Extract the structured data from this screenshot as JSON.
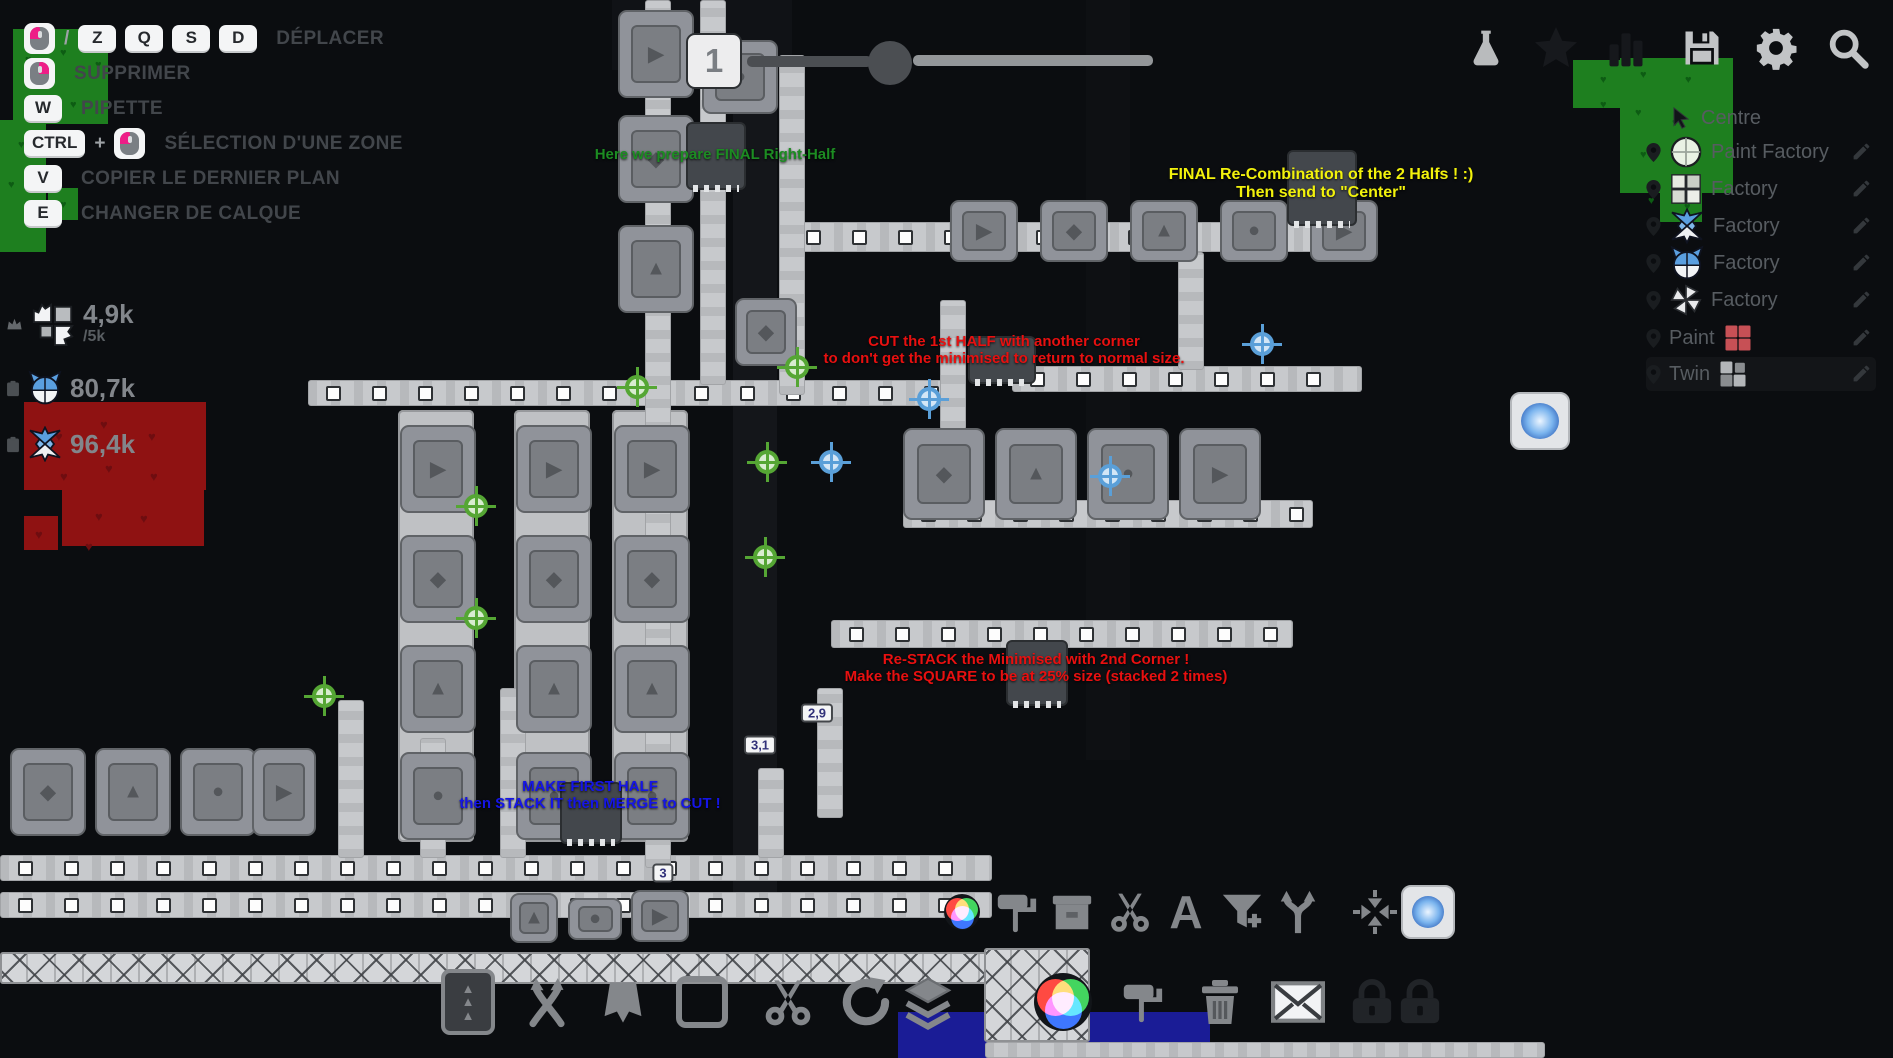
{
  "colors": {
    "background": "#0b0d10",
    "belt": "#c7c9cc",
    "machine": "#90939a",
    "patch_green": "#1e7f1f",
    "patch_red": "#8f1212",
    "patch_blue": "#1a1c96",
    "annotation_yellow": "#f2f20c",
    "annotation_red": "#e81010",
    "annotation_blue": "#1515e6",
    "annotation_green": "#1c8c22",
    "hud_text": "#42464b"
  },
  "hud": {
    "shortcuts": [
      {
        "keys": [
          "MOUSE_LEFT",
          "/",
          "Z",
          "Q",
          "S",
          "D"
        ],
        "label": "DÉPLACER"
      },
      {
        "keys": [
          "MOUSE_RIGHT"
        ],
        "label": "SUPPRIMER"
      },
      {
        "keys": [
          "W"
        ],
        "label": "PIPETTE"
      },
      {
        "keys": [
          "CTRL",
          "+",
          "MOUSE_LEFT"
        ],
        "label": "SÉLECTION D'UNE ZONE"
      },
      {
        "keys": [
          "V"
        ],
        "label": "COPIER LE DERNIER PLAN"
      },
      {
        "keys": [
          "E"
        ],
        "label": "CHANGER DE CALQUE"
      }
    ],
    "counters": [
      {
        "icon": "shape-wings",
        "value": "4,9k",
        "goal": "/5k",
        "crown": true,
        "clipboard": false
      },
      {
        "icon": "shape-cat-blue",
        "value": "80,7k",
        "goal": "",
        "crown": false,
        "clipboard": true
      },
      {
        "icon": "shape-fox-blue",
        "value": "96,4k",
        "goal": "",
        "crown": false,
        "clipboard": true
      }
    ],
    "topbar": {
      "slot": "1"
    },
    "top_buttons": [
      {
        "name": "research-flask",
        "active": true
      },
      {
        "name": "achievements-star",
        "active": false
      },
      {
        "name": "statistics-bars",
        "active": false
      },
      {
        "name": "save-disk",
        "active": true
      },
      {
        "name": "settings-gear",
        "active": true
      },
      {
        "name": "search-magnifier",
        "active": true
      }
    ],
    "markers": [
      {
        "label": "Centre",
        "icon": "cursor-arrow",
        "trailing_icon": "",
        "pin": false,
        "pencil": false
      },
      {
        "label": "Paint Factory",
        "icon": "shape-circle-cross",
        "trailing_icon": "",
        "pin": true,
        "pencil": true
      },
      {
        "label": "Factory",
        "icon": "shape-squares-pale",
        "trailing_icon": "",
        "pin": true,
        "pencil": true
      },
      {
        "label": "Factory",
        "icon": "shape-fox-blue",
        "trailing_icon": "",
        "pin": true,
        "pencil": true
      },
      {
        "label": "Factory",
        "icon": "shape-cat-blue",
        "trailing_icon": "",
        "pin": true,
        "pencil": true
      },
      {
        "label": "Factory",
        "icon": "shape-windmill-white",
        "trailing_icon": "",
        "pin": true,
        "pencil": true
      },
      {
        "label": "Paint",
        "icon": "",
        "trailing_icon": "grid-red",
        "pin": true,
        "pencil": true
      },
      {
        "label": "Twin",
        "icon": "",
        "trailing_icon": "grid-gray",
        "pin": true,
        "pencil": true
      }
    ],
    "toolbar_top": [
      "color-wheel",
      "paint-roller",
      "storage-crate",
      "scissors",
      "letter-A",
      "filter-funnel",
      "splitter-arrows",
      "compress-arrows",
      "crystal-cube"
    ],
    "toolbar_top_letter": "A",
    "toolbar_bottom": [
      "lift-belts",
      "crossed-arrows",
      "half-cape",
      "square-outline",
      "cutter-scissors",
      "rotator-arrow",
      "stacker-layers",
      "color-mixer",
      "paint-roller",
      "trash-can",
      "mail-envelope",
      "lock",
      "lock"
    ]
  },
  "map": {
    "annotations": [
      {
        "id": "prepare-note",
        "color": "#1c8c22",
        "x": 715,
        "y": 146,
        "size": 15,
        "lines": [
          "Here we prepare FINAL Right-Half"
        ]
      },
      {
        "id": "final-note",
        "color": "#f2f20c",
        "x": 1321,
        "y": 166,
        "size": 16,
        "lines": [
          "FINAL Re-Combination of the 2 Halfs ! :)",
          "Then send to \"Center\""
        ]
      },
      {
        "id": "cut-note",
        "color": "#e81010",
        "x": 1004,
        "y": 333,
        "size": 15,
        "lines": [
          "CUT the 1st HALF with another corner",
          "to don't get the minimised to return to normal size."
        ]
      },
      {
        "id": "restack-note",
        "color": "#e81010",
        "x": 1036,
        "y": 651,
        "size": 15,
        "lines": [
          "Re-STACK the Minimised with 2nd Corner !",
          "Make the SQUARE to be at 25% size (stacked 2 times)"
        ]
      },
      {
        "id": "first-half-note",
        "color": "#1515e6",
        "x": 590,
        "y": 778,
        "size": 15,
        "lines": [
          "MAKE FIRST HALF",
          "then STACK IT then MERGE to CUT !"
        ]
      }
    ],
    "throughput_badges": [
      {
        "text": "2,9",
        "x": 817,
        "y": 713
      },
      {
        "text": "3,1",
        "x": 760,
        "y": 745
      },
      {
        "text": "3",
        "x": 663,
        "y": 873
      }
    ]
  }
}
